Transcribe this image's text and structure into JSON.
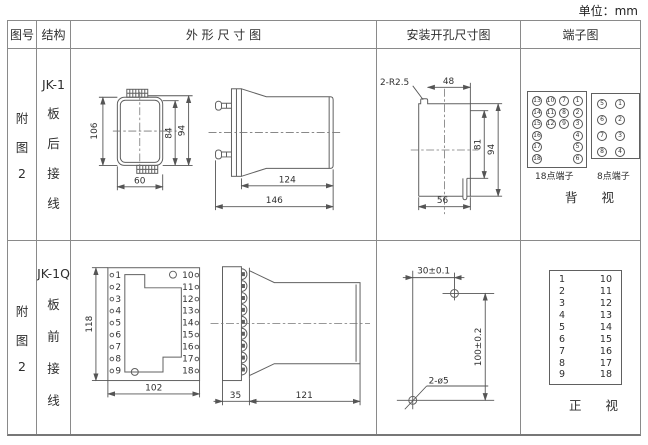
{
  "unit_label": "单位：mm",
  "headers": {
    "fig_no": "图号",
    "structure": "结构",
    "outline": "外 形 尺 寸 图",
    "install": "安装开孔尺寸图",
    "terminal": "端子图"
  },
  "row1": {
    "fig_no_lines": [
      "附",
      "图",
      "2"
    ],
    "structure_lines": [
      "JK-1",
      "板",
      "后",
      "接",
      "线"
    ],
    "outline": {
      "front_height": "106",
      "inner_height": "84",
      "outer_height": "94",
      "front_width": "60",
      "body_length": "124",
      "total_length": "146"
    },
    "install": {
      "corner_radius": "2-R2.5",
      "top_width": "48",
      "inner_height": "81",
      "outer_height": "94",
      "bottom_width": "56"
    },
    "terminal": {
      "block18": {
        "grid": [
          "13",
          "10",
          "7",
          "1",
          "14",
          "11",
          "8",
          "2",
          "15",
          "12",
          "9",
          "3",
          "16",
          "",
          "",
          "4",
          "17",
          "",
          "",
          "5",
          "18",
          "",
          "",
          "6"
        ],
        "label": "18点端子"
      },
      "block8": {
        "grid": [
          "5",
          "1",
          "6",
          "2",
          "7",
          "3",
          "8",
          "4"
        ],
        "label": "8点端子"
      },
      "view_label": "背 视"
    }
  },
  "row2": {
    "fig_no_lines": [
      "附",
      "图",
      "2"
    ],
    "structure_lines": [
      "JK-1Q",
      "板",
      "前",
      "接",
      "线"
    ],
    "outline": {
      "height": "118",
      "width": "102",
      "plate_depth": "35",
      "body_length": "121",
      "pins_left": [
        "1",
        "2",
        "3",
        "4",
        "5",
        "6",
        "7",
        "8",
        "9"
      ],
      "pins_right": [
        "10",
        "11",
        "12",
        "13",
        "14",
        "15",
        "16",
        "17",
        "18"
      ]
    },
    "install": {
      "h_dim": "30±0.1",
      "v_dim": "100±0.2",
      "holes_label": "2-ø5"
    },
    "terminal": {
      "left": [
        "1",
        "2",
        "3",
        "4",
        "5",
        "6",
        "7",
        "8",
        "9"
      ],
      "right": [
        "10",
        "11",
        "12",
        "13",
        "14",
        "15",
        "16",
        "17",
        "18"
      ],
      "view_label": "正 视"
    }
  }
}
